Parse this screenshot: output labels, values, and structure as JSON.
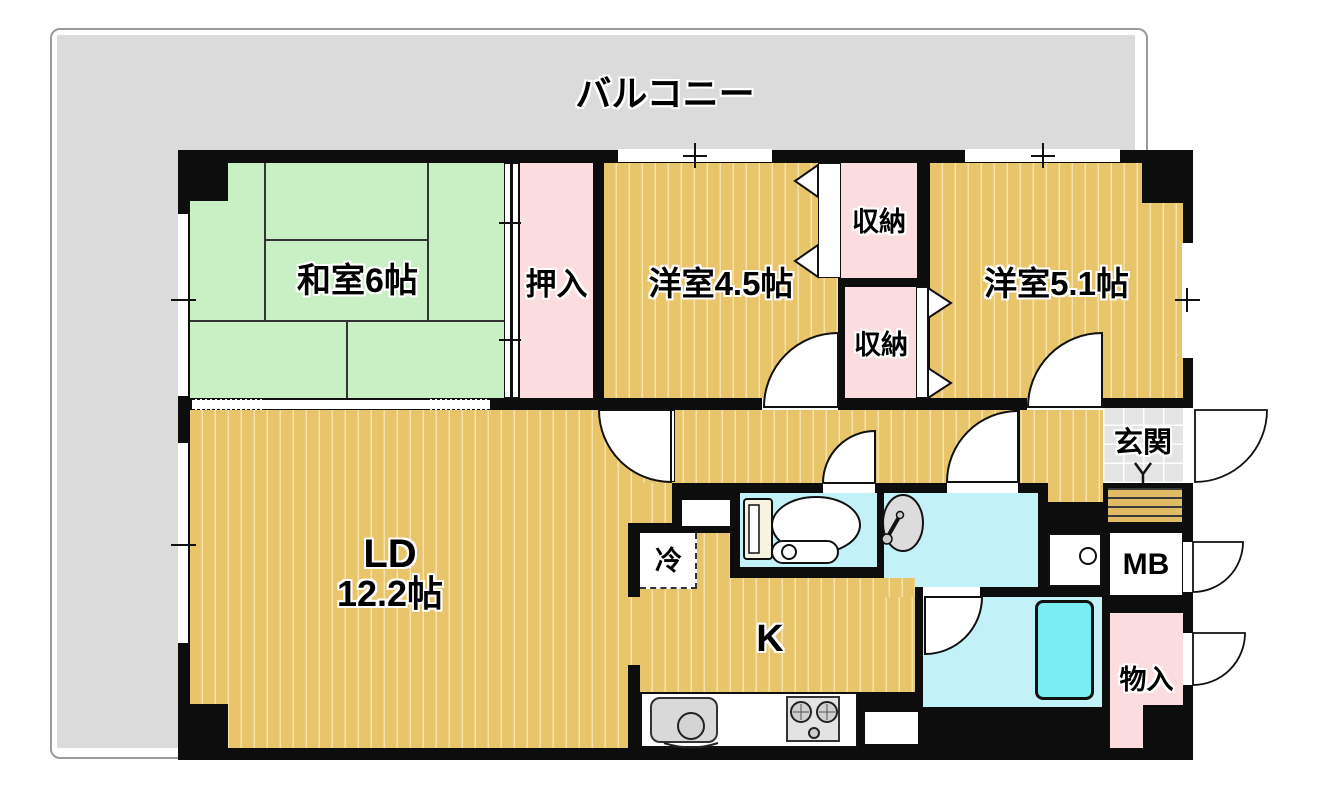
{
  "labels": {
    "balcony": "バルコニー",
    "japanese_room": "和室6帖",
    "oshiire": "押入",
    "western_room_45": "洋室4.5帖",
    "storage_upper": "収納",
    "storage_lower": "収納",
    "western_room_51": "洋室5.1帖",
    "genkan": "玄関",
    "ld": "LD",
    "ld_size": "12.2帖",
    "fridge": "冷",
    "kitchen": "K",
    "meter_box": "MB",
    "storage_entry": "物入"
  },
  "colors": {
    "wall": "#0d0d0d",
    "balcony": "#dbdbdb",
    "tatami_green": "#c9efc5",
    "wood_floor": "#e8c46a",
    "closet_pink": "#fbdcdf",
    "wet_area_cyan": "#c2f2f7",
    "bathtub_cyan": "#79eef2",
    "genkan_tile": "#e4e4e4",
    "fixture_gray": "#d9d9d9"
  }
}
